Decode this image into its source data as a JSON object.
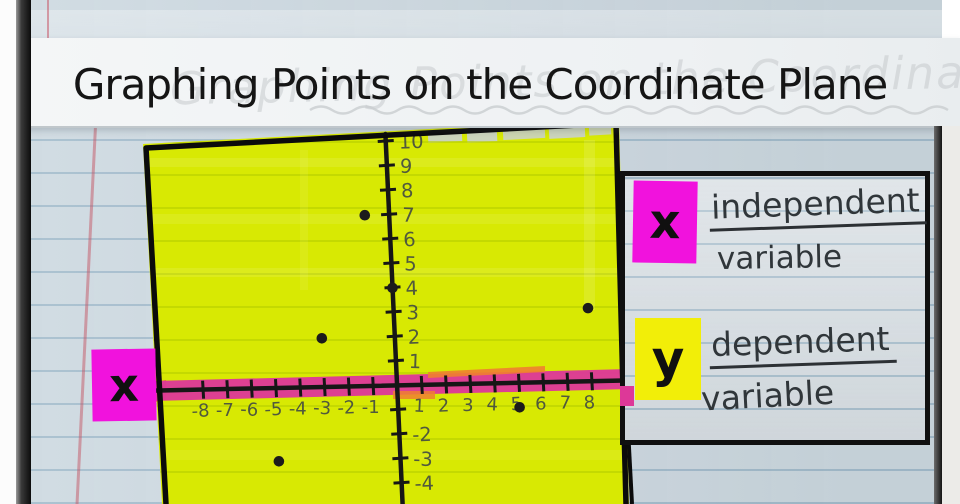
{
  "banner": {
    "title": "Graphing Points on the Coordinate Plane",
    "ghost_text": "Graphing Points on the Coordinate Plane"
  },
  "axis_badge": {
    "symbol": "x"
  },
  "legend": {
    "x": {
      "symbol": "x",
      "line1": "independent",
      "line2": "variable"
    },
    "y": {
      "symbol": "y",
      "line1": "dependent",
      "line2": "variable"
    }
  },
  "chart_data": {
    "type": "scatter",
    "title": "Graphing Points on the Coordinate Plane",
    "xlabel": "x (independent variable)",
    "ylabel": "y (dependent variable)",
    "xlim": [
      -8,
      8
    ],
    "ylim": [
      -5,
      10
    ],
    "grid": "notebook ruled lines",
    "x_tick_labels": [
      "-8",
      "-7",
      "-6",
      "-5",
      "-4",
      "-3",
      "-2",
      "-1",
      "1",
      "2",
      "3",
      "4",
      "5",
      "6",
      "7",
      "8"
    ],
    "y_tick_labels": [
      "10",
      "9",
      "8",
      "7",
      "6",
      "5",
      "4",
      "3",
      "2",
      "1",
      "-2",
      "-3",
      "-4"
    ],
    "y_tick_marks": [
      10,
      9,
      8,
      7,
      6,
      5,
      4,
      3,
      2,
      1,
      -1,
      -2,
      -3,
      -4
    ],
    "points": [
      {
        "x": -1,
        "y": 7
      },
      {
        "x": 0,
        "y": 4
      },
      {
        "x": -3,
        "y": 2
      },
      {
        "x": 8,
        "y": 3
      },
      {
        "x": 5,
        "y": -1
      },
      {
        "x": -5,
        "y": -3
      }
    ]
  },
  "colors": {
    "highlighter_yellow": "#d8e903",
    "axis_highlight_pink": "#dd3898",
    "axis_highlight_orange": "#ee7a28",
    "chip_magenta": "#f112dd",
    "chip_yellow": "#f2ee08",
    "ink_black": "#161616",
    "paper_blue_gray": "#ccd8e0",
    "banner_white": "#f4f6f7"
  }
}
